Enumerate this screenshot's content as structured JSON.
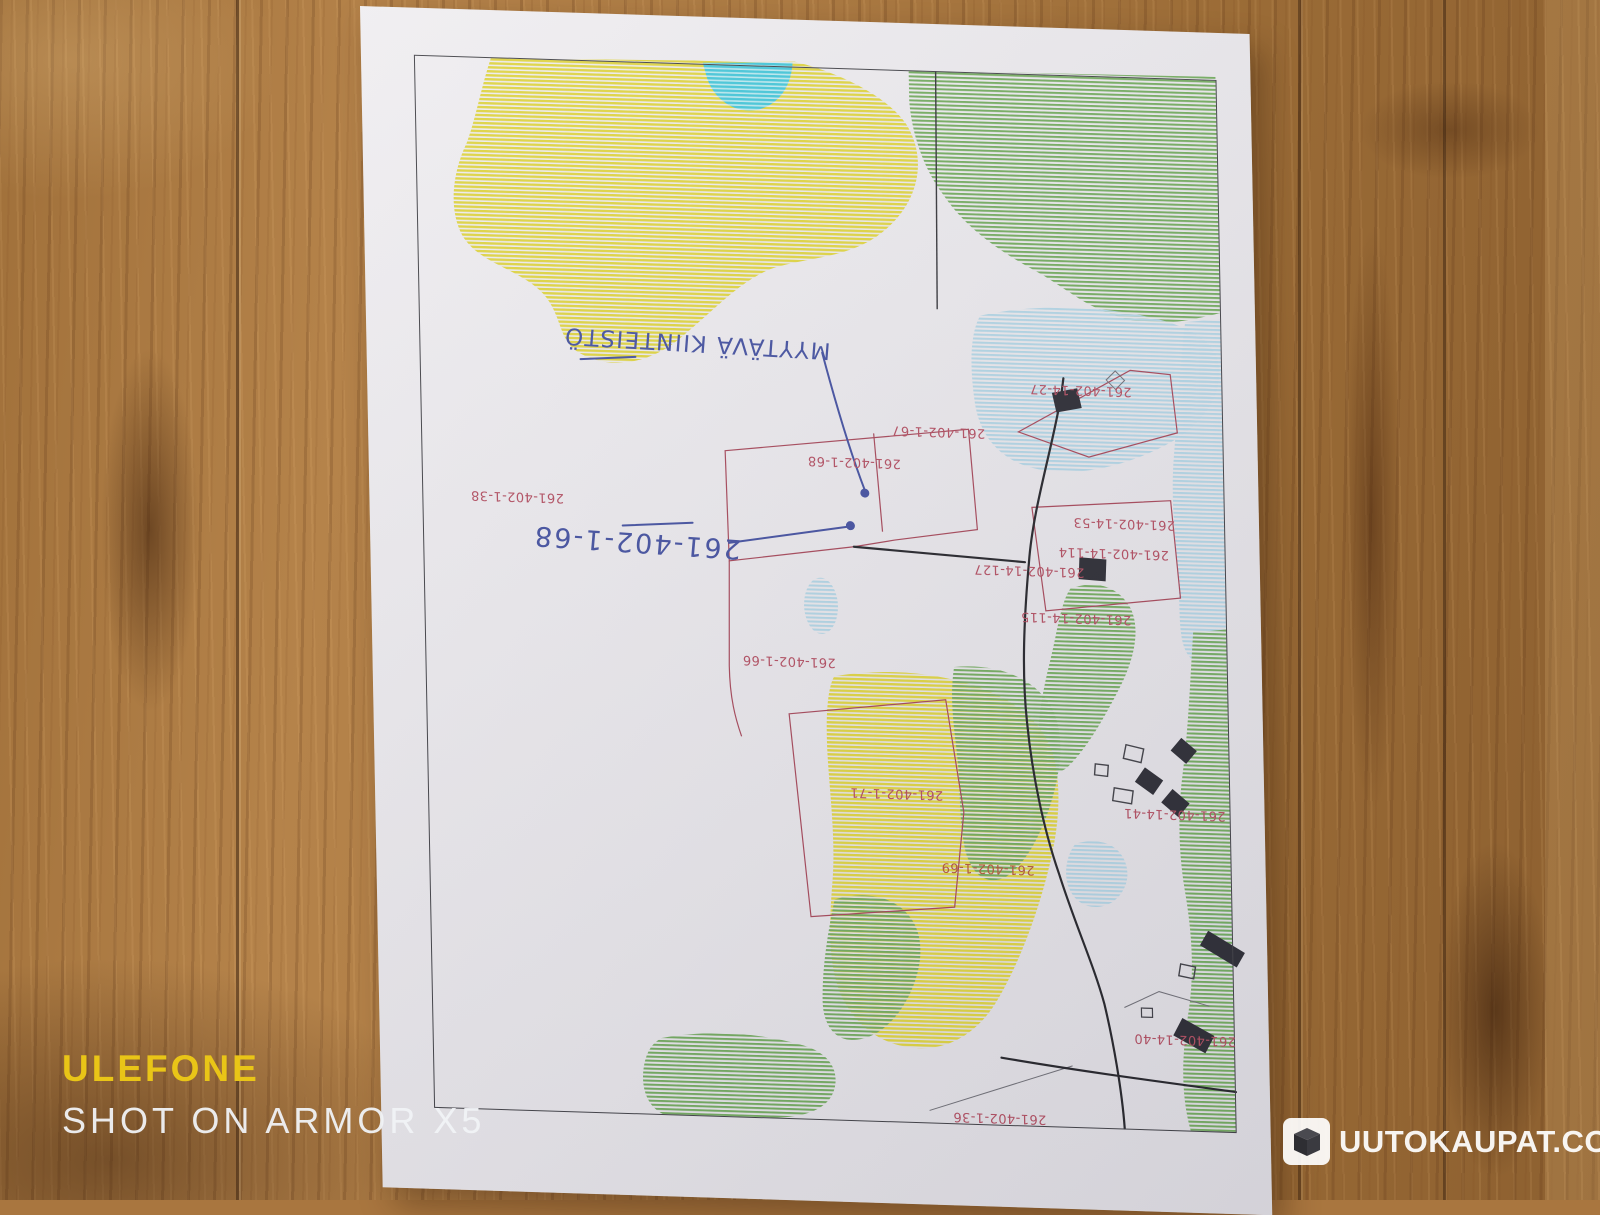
{
  "photo_watermark": {
    "brand": "ULEFONE",
    "caption": "SHOT ON ARMOR X5"
  },
  "site_logo": {
    "icon": "box-cube-icon",
    "text": "UUTOKAUPAT.COM"
  },
  "map": {
    "handwriting": {
      "note": "MYYTÄVÄ KIINTEISTÖ",
      "parcel_ref": "261-402-1-68",
      "ink_color": "#3e4b9c"
    },
    "parcel_labels": [
      "261-402-1-67",
      "261-402-1-68",
      "261-402-1-38",
      "261-402-14-27",
      "261-402-14-53",
      "261-402-14-114",
      "261-402-14-127",
      "261-402-14-115",
      "261-402-1-66",
      "261-402-1-71",
      "261-402-1-69",
      "261-402-14-41",
      "261-402-14-40",
      "261-402-1-36"
    ],
    "legend_colors": {
      "parcel_label_red": "#b0495c",
      "field_yellow": "#ddd23c",
      "forest_green": "#6fa85a",
      "water_cyan": "#3fc3d6",
      "wetland_blue": "#aed2e2",
      "building_black": "#26262e"
    }
  }
}
